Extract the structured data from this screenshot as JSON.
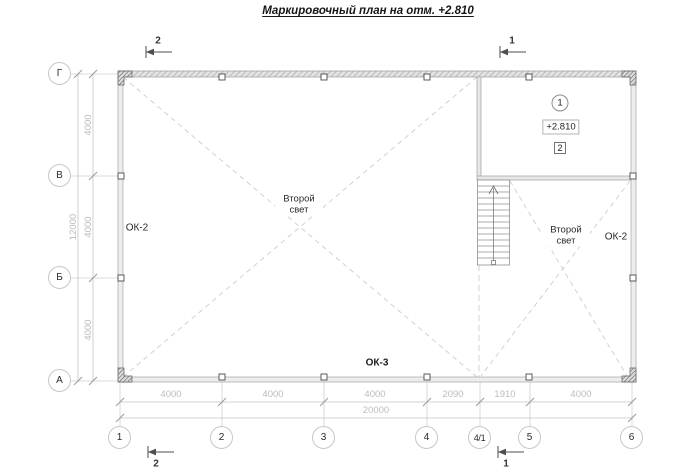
{
  "title": "Маркировочный план на отм. +2.810",
  "axes": {
    "vertical": [
      "Г",
      "В",
      "Б",
      "А"
    ],
    "horizontal": [
      "1",
      "2",
      "3",
      "4",
      "4/1",
      "5",
      "6"
    ]
  },
  "dimensions": {
    "left_segments": [
      "4000",
      "4000",
      "4000"
    ],
    "left_total": "12000",
    "bottom_segments": [
      "4000",
      "4000",
      "4000",
      "2090",
      "1910",
      "4000"
    ],
    "bottom_total": "20000"
  },
  "labels": {
    "window_left": "ОК-2",
    "window_right": "ОК-2",
    "window_bottom": "ОК-3",
    "second_light_left": "Второй свет",
    "second_light_right": "Второй свет",
    "elevation": "+2.810",
    "room_tag": "1",
    "note_tag": "2"
  },
  "sections": {
    "top_left": "2",
    "top_right": "1",
    "bottom_left": "2",
    "bottom_right": "1"
  },
  "colors": {
    "dim_line": "#c4c4c4",
    "dim_text": "#bcbcbc",
    "wall_fill": "#ededed",
    "wall_stroke": "#b0b0b0",
    "dash": "#cdcdcd",
    "dark_text": "#1f1f1f"
  }
}
